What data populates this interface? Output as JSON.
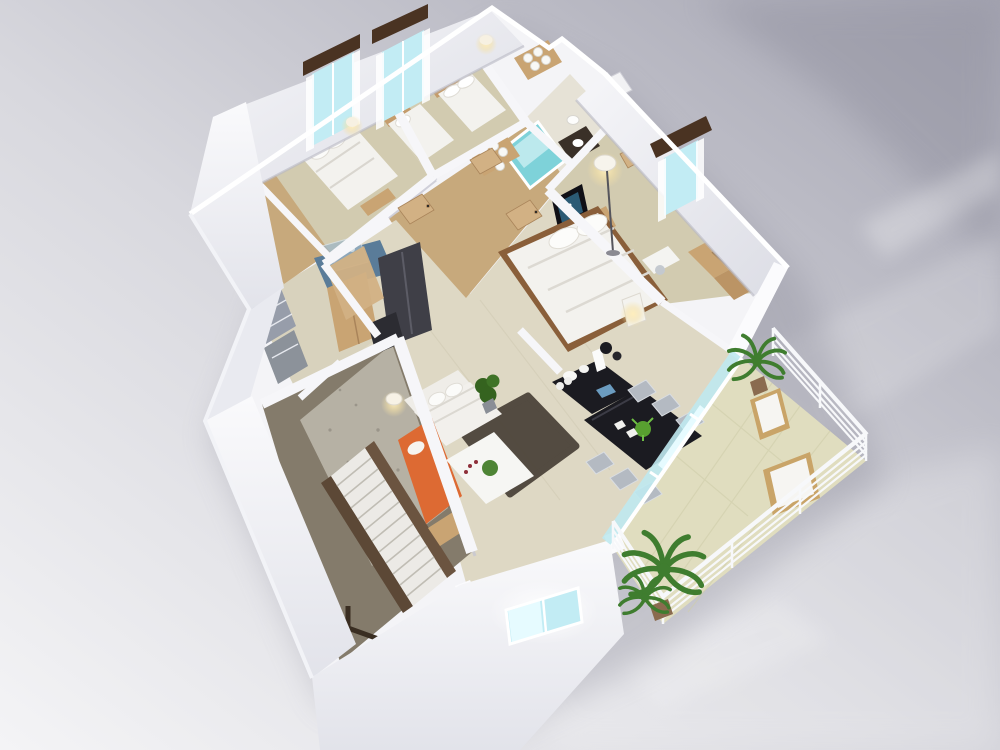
{
  "scene": {
    "type": "isometric-3d-floorplan-render",
    "rooms": [
      {
        "name": "bedroom-left",
        "objects": [
          "double-bed",
          "headboard",
          "nightstand-lamp",
          "window-curtains",
          "wardrobe-strip"
        ]
      },
      {
        "name": "bedroom-middle",
        "objects": [
          "single-bed",
          "double-bed",
          "window-curtains",
          "towel-closet"
        ]
      },
      {
        "name": "bathroom",
        "objects": [
          "teal-shower",
          "vanity-sink",
          "toilet",
          "washer",
          "mirror"
        ]
      },
      {
        "name": "master-bedroom",
        "objects": [
          "king-bed",
          "tv",
          "media-console",
          "floor-lamp",
          "window-valance",
          "wardrobe",
          "desk-chair"
        ]
      },
      {
        "name": "kitchen",
        "objects": [
          "blue-counter",
          "glass-display",
          "fridge",
          "wood-cabinet",
          "trash-unit"
        ]
      },
      {
        "name": "entry-hall",
        "objects": [
          "shoe-cabinets",
          "tall-cabinet",
          "wood-floor"
        ]
      },
      {
        "name": "stairwell",
        "objects": [
          "staircase",
          "handrail",
          "concrete-floor"
        ]
      },
      {
        "name": "living-room",
        "objects": [
          "white-sofa",
          "orange-chaise",
          "shag-rug",
          "coffee-table",
          "potted-plant",
          "floor-lamp"
        ]
      },
      {
        "name": "dining-room",
        "objects": [
          "black-table",
          "six-chairs",
          "black-sideboard",
          "white-vases",
          "centerpiece-plant"
        ]
      },
      {
        "name": "balcony",
        "objects": [
          "white-railing",
          "palm-tree-large",
          "palm-tree-small",
          "wood-lounger",
          "wood-lounger-2",
          "glass-sliding-doors"
        ]
      }
    ]
  },
  "colors": {
    "bg_dark": "#a4a4b1",
    "bg_mid": "#d7d7de",
    "bg_light": "#f3f3f6",
    "shadow": "#7f7f8e",
    "wall_white": "#f6f6f9",
    "wall_face": "#ececf1",
    "wall_shade": "#c7c7d2",
    "floor_bedroom": "#d2cbb0",
    "floor_hall_wood": "#c7a97c",
    "floor_open": "#ded8c4",
    "floor_entry": "#d8d2bd",
    "floor_bath": "#e6e2d6",
    "floor_balcony": "#e0ddbf",
    "floor_stair": "#847b6b",
    "floor_concrete": "#b6b1a4",
    "teal": "#7ed2d9",
    "teal_light": "#bce9ed",
    "glass": "#c2ecf4",
    "glass_bright": "#e6fbff",
    "valance": "#4a3322",
    "bed": "#f3f2ee",
    "bed_shadow": "#d9d6cf",
    "headboard": "#c49c6c",
    "wood": "#c9a473",
    "wood_dark": "#8a5f3a",
    "counter_blue": "#5a7c99",
    "fridge": "#3f3f47",
    "black": "#1b1b21",
    "chair": "#b4bac2",
    "sofa": "#efede8",
    "orange": "#dd6a33",
    "rug": "#4c443a",
    "plant": "#4e8435",
    "plant_dark": "#35631f",
    "palm": "#3f7d2f",
    "pot": "#8a6b4f",
    "railing": "#f7f8fa",
    "lamp_glow": "#f6e2a6",
    "tv_screen": "#2b5a74",
    "stringer": "#5c4836",
    "gray_cabinet": "#979daa"
  }
}
